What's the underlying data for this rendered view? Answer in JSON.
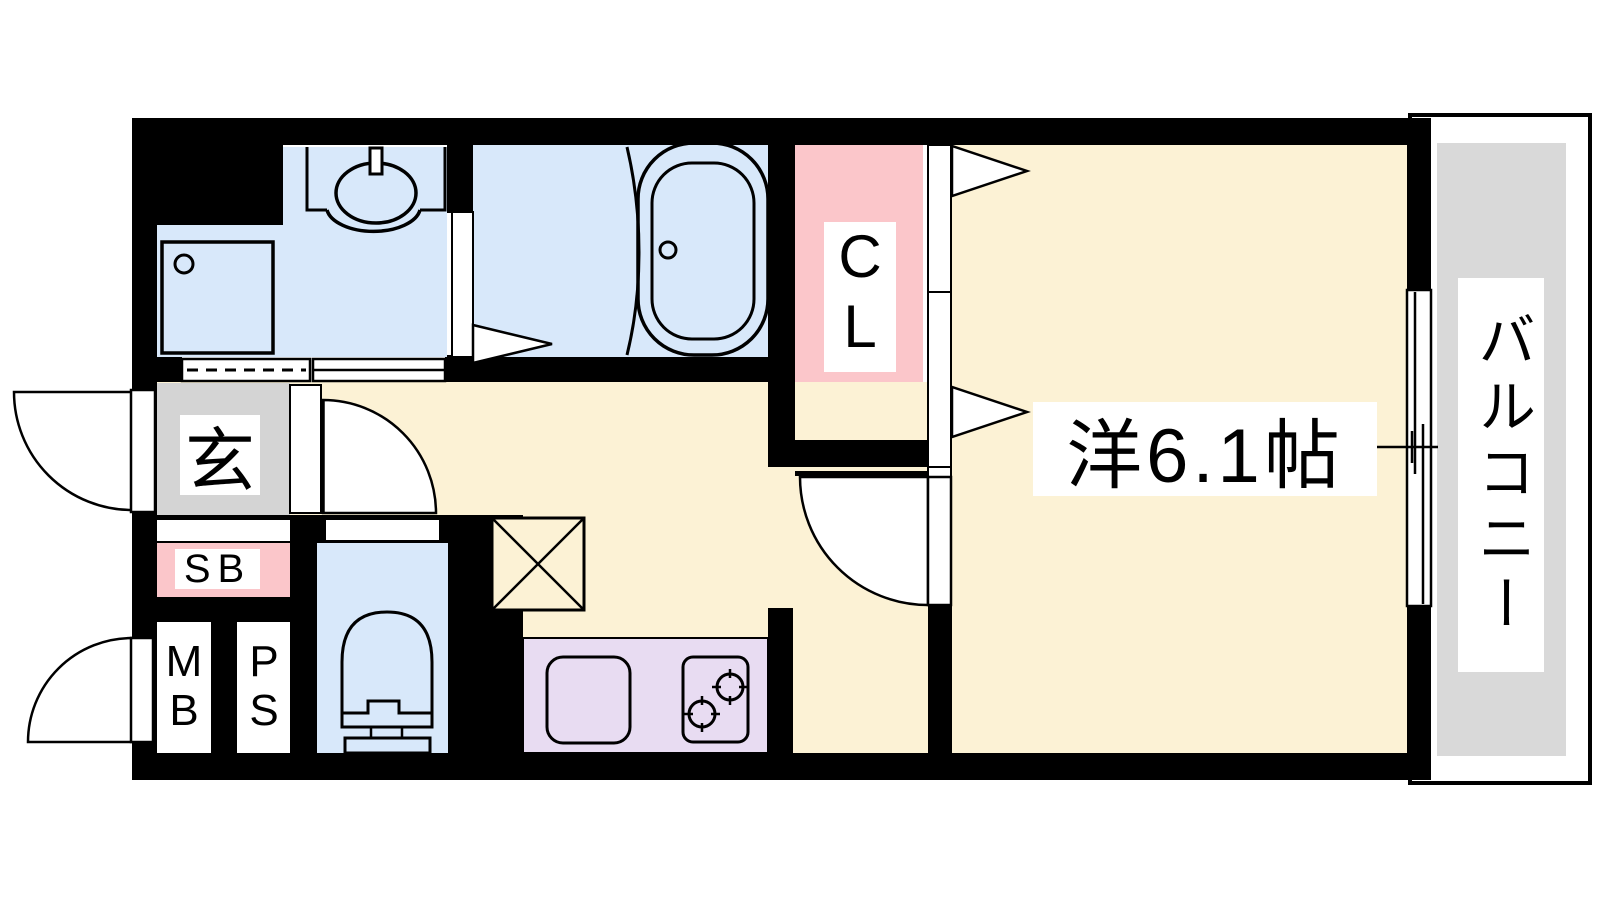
{
  "plan": {
    "type": "apartment-floor-plan",
    "labels": {
      "western_room": "洋6.1帖",
      "balcony": "バルコニー",
      "closet": "CL",
      "entrance": "玄",
      "shoe_box": "SB",
      "meter_box": "MB",
      "pipe_space": "PS"
    }
  },
  "colors": {
    "wall": "#000000",
    "wet_area_blue": "#d8e8fa",
    "room_cream": "#fcf2d5",
    "closet_pink": "#fbc6ca",
    "kitchen_lavender": "#e8dcf2",
    "entrance_gray": "#d4d4d4",
    "balcony_gray": "#d9d9d9",
    "label_bg": "#ffffff"
  }
}
